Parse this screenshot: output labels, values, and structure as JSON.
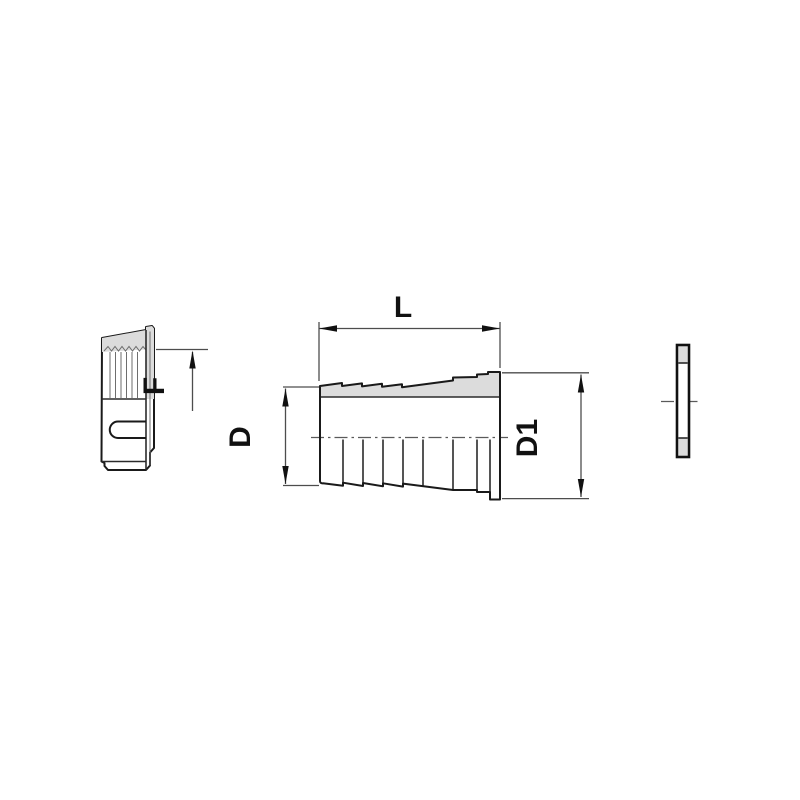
{
  "labels": {
    "l": "L",
    "f": "F",
    "d": "D",
    "d1": "D1"
  },
  "colors": {
    "background": "#ffffff",
    "outline": "#1a1a1a",
    "section_fill": "#dcdcdc",
    "dimension_line": "#4d4d4d",
    "centerline": "#5a5a5a",
    "label_text": "#111111"
  }
}
